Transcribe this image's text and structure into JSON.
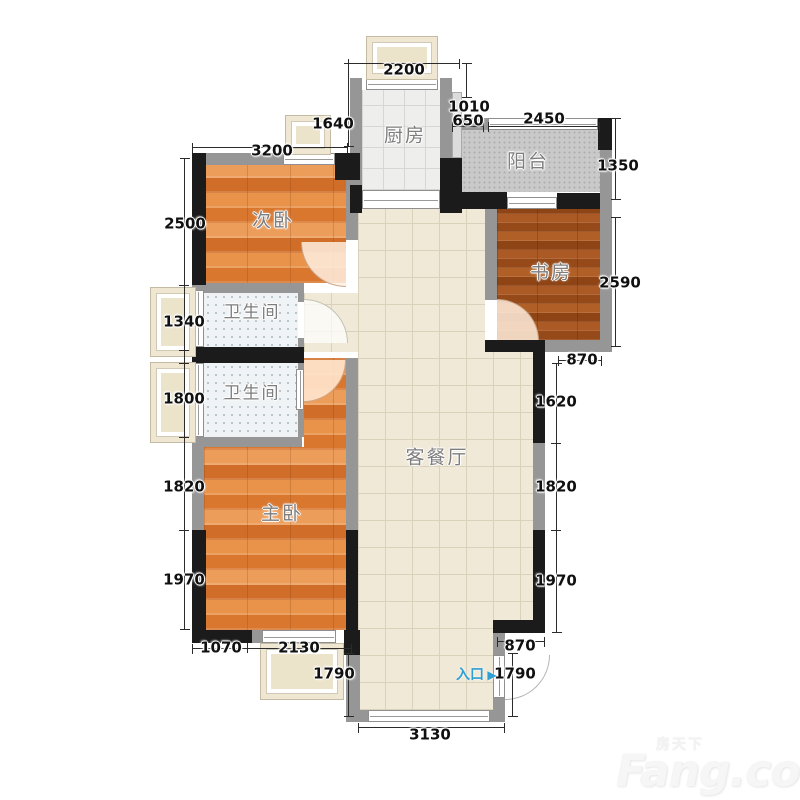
{
  "rooms": {
    "bedroom2": "次卧",
    "kitchen": "厨房",
    "balcony": "阳台",
    "study": "书房",
    "bath1": "卫生间",
    "bath2": "卫生间",
    "master": "主卧",
    "living": "客餐厅"
  },
  "dims": {
    "kitchen_window_top": "2200",
    "kitchen_left_height": "1640",
    "bedroom2_top_width": "3200",
    "balcony_offset_a": "1010",
    "balcony_offset_b": "650",
    "balcony_window_width": "2450",
    "left_bedroom2": "2500",
    "left_bath1": "1340",
    "left_bath2": "1800",
    "left_master_upper": "1820",
    "left_master_lower": "1970",
    "right_balcony": "1350",
    "right_study": "2590",
    "right_step": "870",
    "right_living_upper": "1620",
    "right_living_mid": "1820",
    "right_living_lower": "1970",
    "bottom_master_a": "1070",
    "bottom_master_b": "2130",
    "bottom_left_column": "1790",
    "bottom_step": "870",
    "bottom_entrance": "1790",
    "bottom_living_width": "3130"
  },
  "entrance": {
    "label": "入口",
    "arrow": "▶"
  },
  "watermark": {
    "cn": "房天下",
    "en": "Fang.com"
  },
  "colors": {
    "wall_gray": "#969696",
    "wall_black": "#1b1b1b",
    "wood_orange": "#e1873f",
    "wood_brown": "#a2521f",
    "tile_beige": "#f0e9d8",
    "tile_kitchen": "#eeeeec",
    "tile_bath": "#f0f3f5",
    "tile_balcony": "#c9c9c9",
    "entrance_blue": "#2e9fd4",
    "dimension_text": "#101010"
  }
}
